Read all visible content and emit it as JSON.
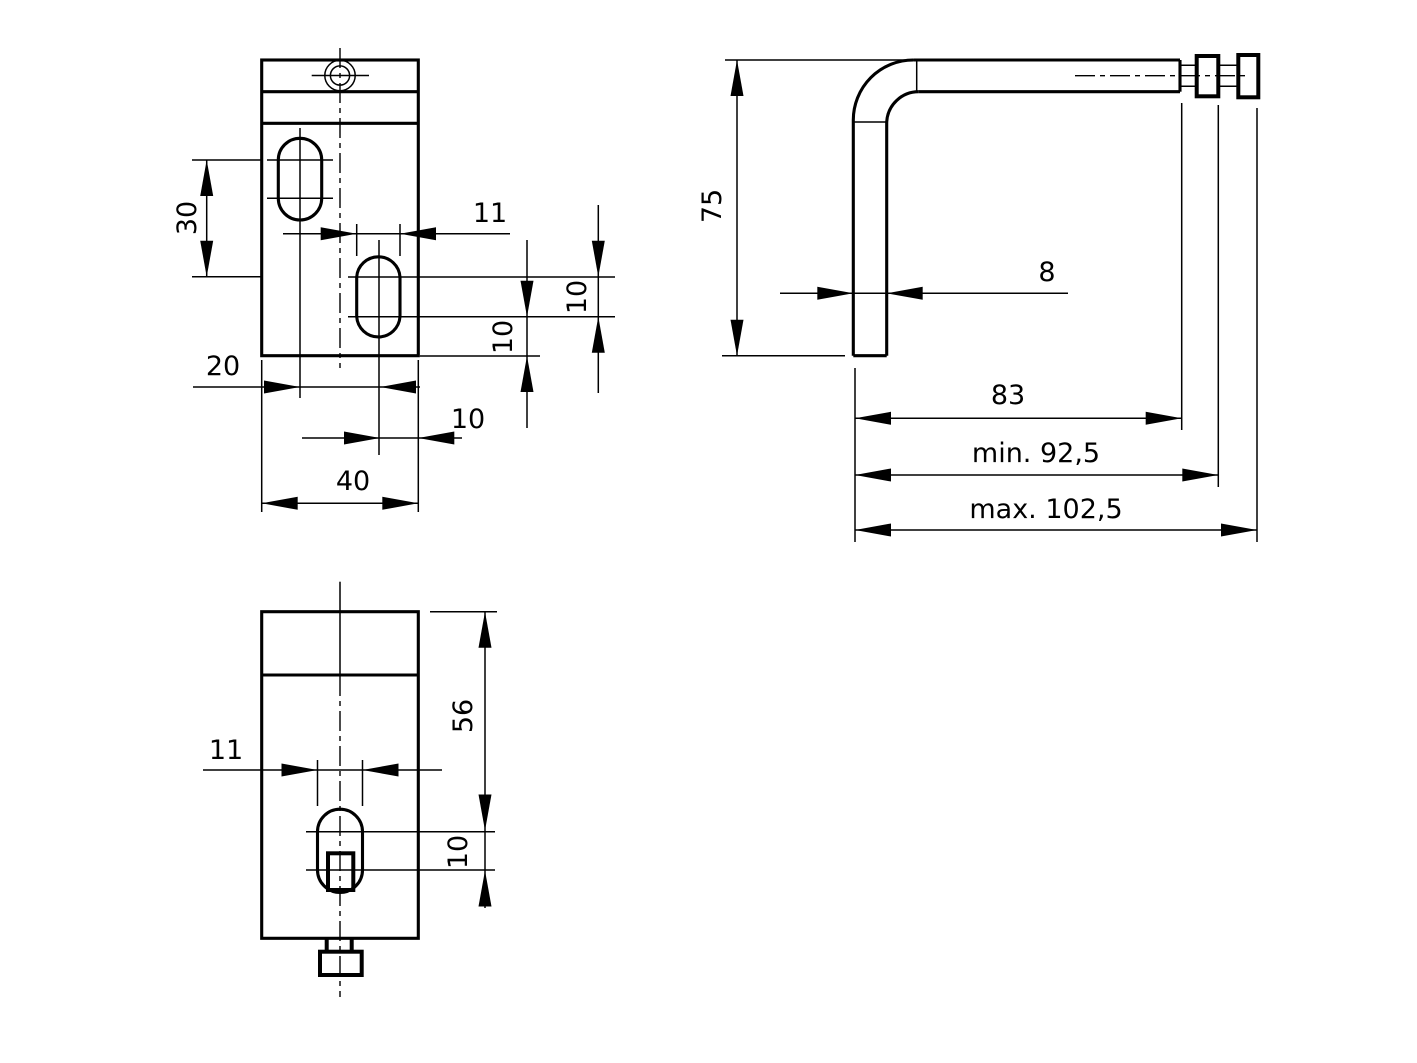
{
  "drawing": {
    "type": "technical-drawing",
    "colors": {
      "background": "#ffffff",
      "line": "#000000"
    },
    "labels": {
      "front_view": {
        "slot_vertical_offset": "30",
        "slot_width": "11",
        "slot_arc_spacing": "10",
        "slot_to_bottom": "10",
        "slot_centers_distance": "20",
        "slot_center_to_edge": "10",
        "part_width": "40"
      },
      "side_view": {
        "leg_height": "75",
        "material_thickness": "8",
        "arm_length": "83",
        "length_min": "min. 92,5",
        "length_max": "max. 102,5"
      },
      "bottom_view": {
        "slot_width": "11",
        "slot_position": "56",
        "slot_arc_spacing": "10"
      }
    }
  }
}
